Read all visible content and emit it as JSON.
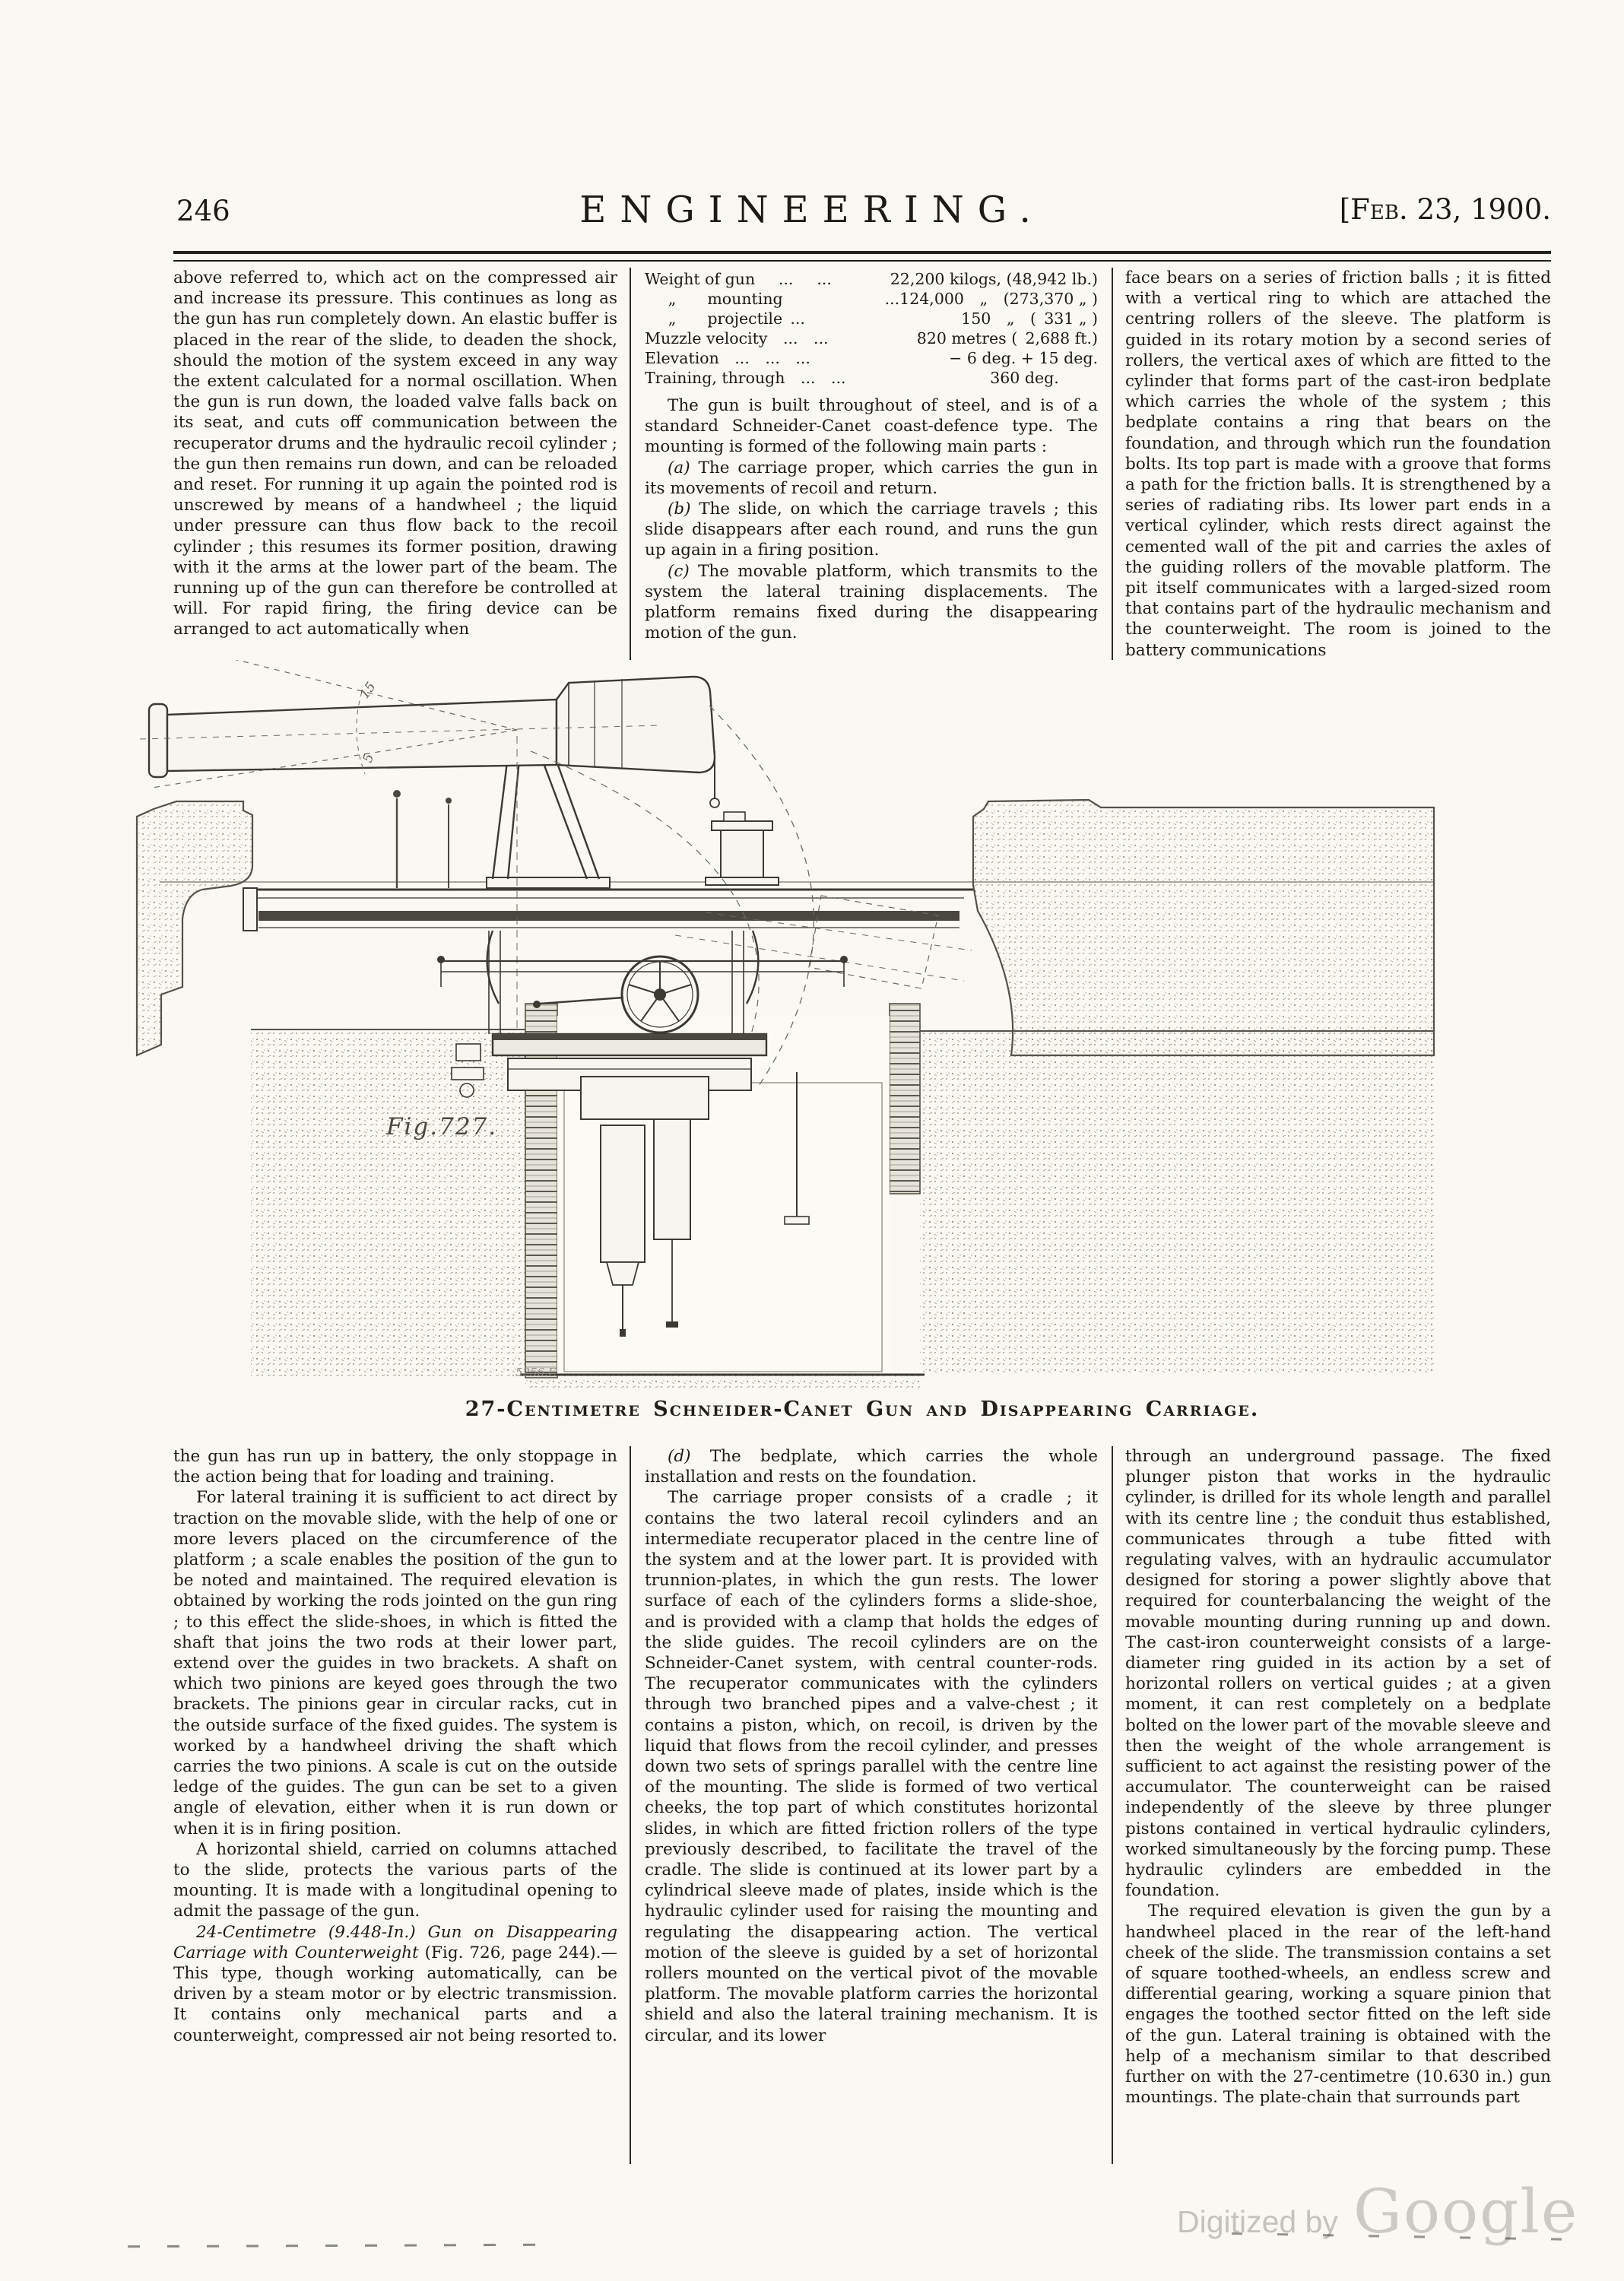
{
  "header": {
    "page_number": "246",
    "title": "ENGINEERING.",
    "date": "[Feb. 23, 1900."
  },
  "top_left": {
    "p1": "above referred to, which act on the compressed air and increase its pressure. This continues as long as the gun has run completely down. An elastic buffer is placed in the rear of the slide, to deaden the shock, should the motion of the system exceed in any way the extent calculated for a normal oscillation. When the gun is run down, the loaded valve falls back on its seat, and cuts off communication between the recuperator drums and the hydraulic recoil cylinder ; the gun then remains run down, and can be reloaded and reset. For running it up again the pointed rod is unscrewed by means of a handwheel ; the liquid under pressure can thus flow back to the recoil cylinder ; this resumes its former position, drawing with it the arms at the lower part of the beam. The running up of the gun can therefore be controlled at will. For rapid firing, the firing device can be arranged to act automatically when"
  },
  "top_middle": {
    "specs": [
      {
        "label": "Weight of gun  ...  ...",
        "value": "22,200 kilogs, (48,942 lb.)"
      },
      {
        "label": "  „  mounting",
        "value": "...124,000 „ (273,370 „ )"
      },
      {
        "label": "  „  projectile ...",
        "value": "150 „ ( 331 „ )"
      },
      {
        "label": "Muzzle velocity ... ...",
        "value": "820 metres ( 2,688 ft.)"
      },
      {
        "label": "Elevation ... ... ...",
        "value": "− 6 deg. + 15 deg."
      },
      {
        "label": "Training, through ... ...",
        "value": "360 deg.   "
      }
    ],
    "p1": "The gun is built throughout of steel, and is of a standard Schneider-Canet coast-defence type. The mounting is formed of the following main parts :",
    "items": [
      {
        "tag": "(a)",
        "text": "The carriage proper, which carries the gun in its movements of recoil and return."
      },
      {
        "tag": "(b)",
        "text": "The slide, on which the carriage travels ; this slide disappears after each round, and runs the gun up again in a firing position."
      },
      {
        "tag": "(c)",
        "text": "The movable platform, which transmits to the system the lateral training displacements. The platform remains fixed during the disappearing motion of the gun."
      }
    ]
  },
  "top_right": {
    "p1": "face bears on a series of friction balls ; it is fitted with a vertical ring to which are attached the centring rollers of the sleeve. The platform is guided in its rotary motion by a second series of rollers, the vertical axes of which are fitted to the cylinder that forms part of the cast-iron bedplate which carries the whole of the system ; this bedplate contains a ring that bears on the foundation, and through which run the foundation bolts. Its top part is made with a groove that forms a path for the friction balls. It is strengthened by a series of radiating ribs. Its lower part ends in a vertical cylinder, which rests direct against the cemented wall of the pit and carries the axles of the guiding rollers of the movable platform. The pit itself communicates with a larged-sized room that contains part of the hydraulic mechanism and the counterweight. The room is joined to the battery communications"
  },
  "figure": {
    "label": "Fig.727.",
    "plate_mark": "5256.E",
    "angle_upper": "15",
    "angle_lower": "5",
    "caption": "27-Centimetre Schneider-Canet Gun and Disappearing Carriage."
  },
  "bottom_left": {
    "p1": "the gun has run up in battery, the only stoppage in the action being that for loading and training.",
    "p2": "For lateral training it is sufficient to act direct by traction on the movable slide, with the help of one or more levers placed on the circumference of the platform ; a scale enables the position of the gun to be noted and maintained. The required elevation is obtained by working the rods jointed on the gun ring ; to this effect the slide-shoes, in which is fitted the shaft that joins the two rods at their lower part, extend over the guides in two brackets. A shaft on which two pinions are keyed goes through the two brackets. The pinions gear in circular racks, cut in the outside surface of the fixed guides. The system is worked by a handwheel driving the shaft which carries the two pinions. A scale is cut on the outside ledge of the guides. The gun can be set to a given angle of elevation, either when it is run down or when it is in firing position.",
    "p3": "A horizontal shield, carried on columns attached to the slide, protects the various parts of the mounting. It is made with a longitudinal opening to admit the passage of the gun.",
    "p4_lead": "24-Centimetre (9.448-In.) Gun on Disappearing Carriage with Counterweight",
    "p4_rest": " (Fig. 726, page 244).—This type, though working automatically, can be driven by a steam motor or by electric transmission. It contains only mechanical parts and a counterweight, compressed air not being resorted to."
  },
  "bottom_middle": {
    "p1_tag": "(d)",
    "p1": "The bedplate, which carries the whole installation and rests on the foundation.",
    "p2": "The carriage proper consists of a cradle ; it contains the two lateral recoil cylinders and an intermediate recuperator placed in the centre line of the system and at the lower part. It is provided with trunnion-plates, in which the gun rests. The lower surface of each of the cylinders forms a slide-shoe, and is provided with a clamp that holds the edges of the slide guides. The recoil cylinders are on the Schneider-Canet system, with central counter-rods. The recuperator communicates with the cylinders through two branched pipes and a valve-chest ; it contains a piston, which, on recoil, is driven by the liquid that flows from the recoil cylinder, and presses down two sets of springs parallel with the centre line of the mounting. The slide is formed of two vertical cheeks, the top part of which constitutes horizontal slides, in which are fitted friction rollers of the type previously described, to facilitate the travel of the cradle. The slide is continued at its lower part by a cylindrical sleeve made of plates, inside which is the hydraulic cylinder used for raising the mounting and regulating the disappearing action. The vertical motion of the sleeve is guided by a set of horizontal rollers mounted on the vertical pivot of the movable platform. The movable platform carries the horizontal shield and also the lateral training mechanism. It is circular, and its lower"
  },
  "bottom_right": {
    "p1": "through an underground passage. The fixed plunger piston that works in the hydraulic cylinder, is drilled for its whole length and parallel with its centre line ; the conduit thus established, communicates through a tube fitted with regulating valves, with an hydraulic accumulator designed for storing a power slightly above that required for counterbalancing the weight of the movable mounting during running up and down. The cast-iron counterweight consists of a large-diameter ring guided in its action by a set of horizontal rollers on vertical guides ; at a given moment, it can rest completely on a bedplate bolted on the lower part of the movable sleeve and then the weight of the whole arrangement is sufficient to act against the resisting power of the accumulator. The counterweight can be raised independently of the sleeve by three plunger pistons contained in vertical hydraulic cylinders, worked simultaneously by the forcing pump. These hydraulic cylinders are embedded in the foundation.",
    "p2": "The required elevation is given the gun by a handwheel placed in the rear of the left-hand cheek of the slide. The transmission contains a set of square toothed-wheels, an endless screw and differential gearing, working a square pinion that engages the toothed sector fitted on the left side of the gun. Lateral training is obtained with the help of a mechanism similar to that described further on with the 27-centimetre (10.630 in.) gun mountings. The plate-chain that surrounds part"
  },
  "watermark": {
    "prefix": "Digitized by",
    "brand": "Google"
  }
}
